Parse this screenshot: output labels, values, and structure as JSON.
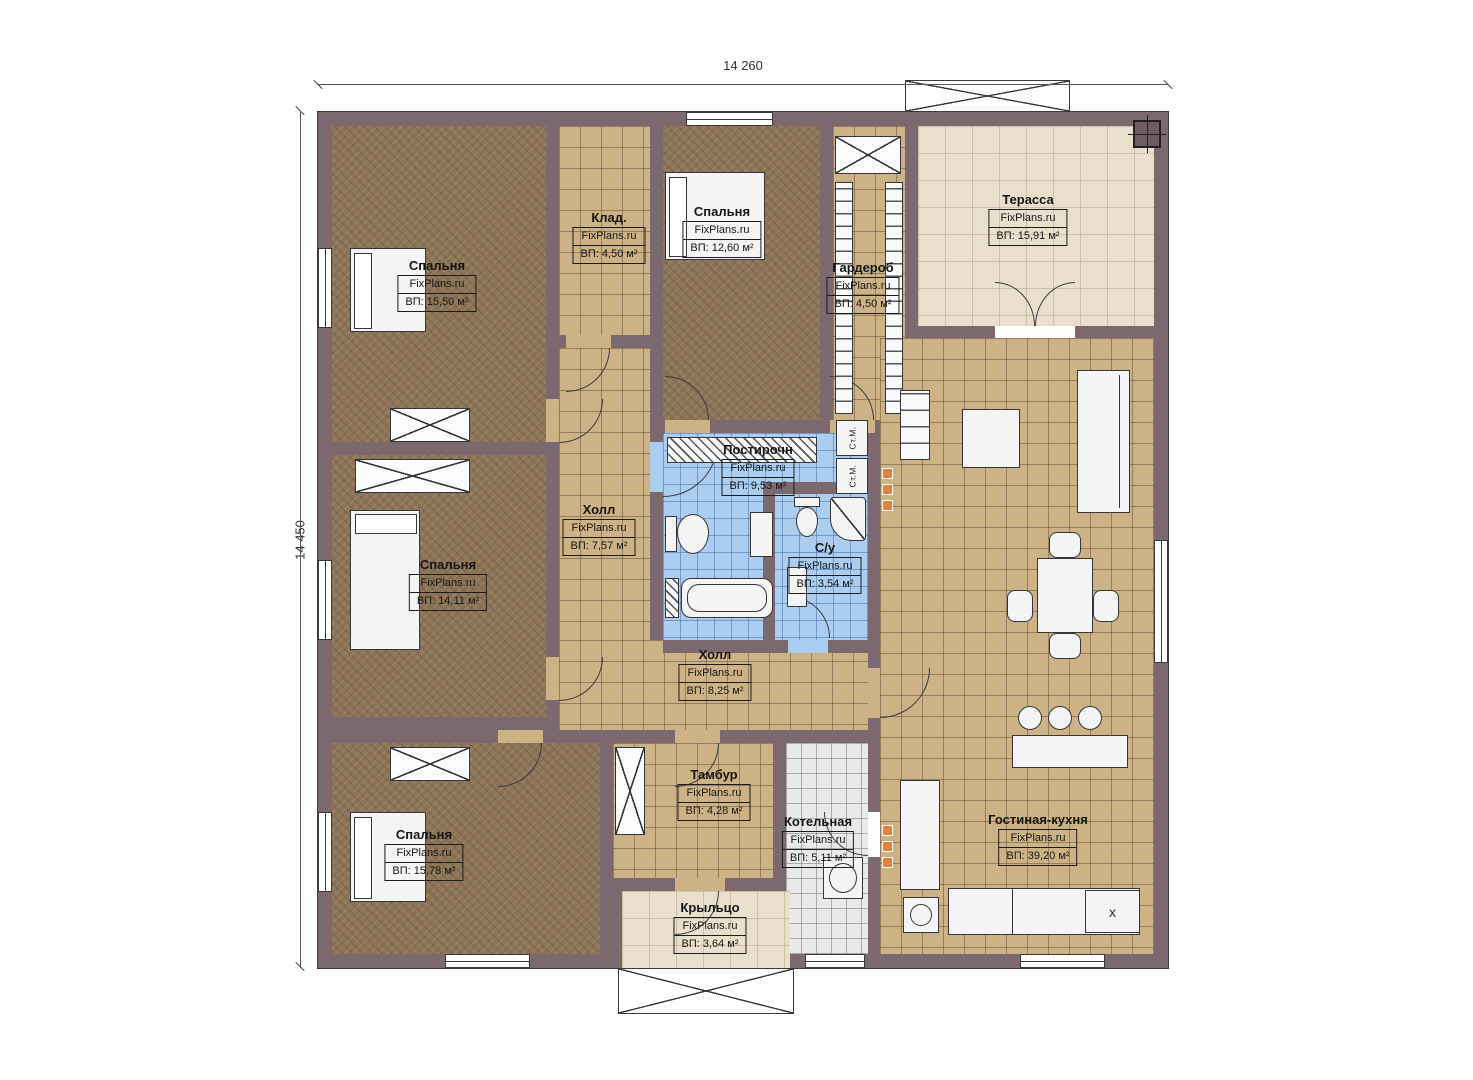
{
  "site": "FixPlans.ru",
  "dimensions": {
    "top": "14 260",
    "left": "14 450"
  },
  "rooms": [
    {
      "id": "bedroom-1",
      "name": "Спальня",
      "site": "FixPlans.ru",
      "area": "ВП: 15,50 м²"
    },
    {
      "id": "storage",
      "name": "Клад.",
      "site": "FixPlans.ru",
      "area": "ВП: 4,50 м²"
    },
    {
      "id": "bedroom-2",
      "name": "Спальня",
      "site": "FixPlans.ru",
      "area": "ВП: 12,60 м²"
    },
    {
      "id": "wardrobe",
      "name": "Гардероб",
      "site": "FixPlans.ru",
      "area": "ВП: 4,50 м²"
    },
    {
      "id": "terrace",
      "name": "Терасса",
      "site": "FixPlans.ru",
      "area": "ВП: 15,91 м²"
    },
    {
      "id": "laundry",
      "name": "Постирочн",
      "site": "FixPlans.ru",
      "area": "ВП: 9,53 м²"
    },
    {
      "id": "hall-1",
      "name": "Холл",
      "site": "FixPlans.ru",
      "area": "ВП: 7,57 м²"
    },
    {
      "id": "bathroom",
      "name": "С/у",
      "site": "FixPlans.ru",
      "area": "ВП: 3,54 м²"
    },
    {
      "id": "bedroom-3",
      "name": "Спальня",
      "site": "FixPlans.ru",
      "area": "ВП: 14,11 м²"
    },
    {
      "id": "hall-2",
      "name": "Холл",
      "site": "FixPlans.ru",
      "area": "ВП: 8,25 м²"
    },
    {
      "id": "bedroom-4",
      "name": "Спальня",
      "site": "FixPlans.ru",
      "area": "ВП: 15,78 м²"
    },
    {
      "id": "vestibule",
      "name": "Тамбур",
      "site": "FixPlans.ru",
      "area": "ВП: 4,28 м²"
    },
    {
      "id": "boiler-room",
      "name": "Котельная",
      "site": "FixPlans.ru",
      "area": "ВП: 5,11 м²"
    },
    {
      "id": "living-kitchen",
      "name": "Гостиная-кухня",
      "site": "FixPlans.ru",
      "area": "ВП: 39,20 м²"
    },
    {
      "id": "porch",
      "name": "Крыльцо",
      "site": "FixPlans.ru",
      "area": "ВП: 3,64 м²"
    }
  ],
  "fixtures": {
    "washer_label": "Ст.М.",
    "stove_marker": "x"
  },
  "colors": {
    "wall": "#7c6970",
    "floor_bedroom": "#8d7457",
    "floor_tile": "#cdb285",
    "floor_wet": "#aacdf0",
    "floor_boiler": "#e9e9e9",
    "floor_terrace": "#e9dfcc",
    "furniture": "#f4f4f4",
    "marker": "#e5813e"
  }
}
